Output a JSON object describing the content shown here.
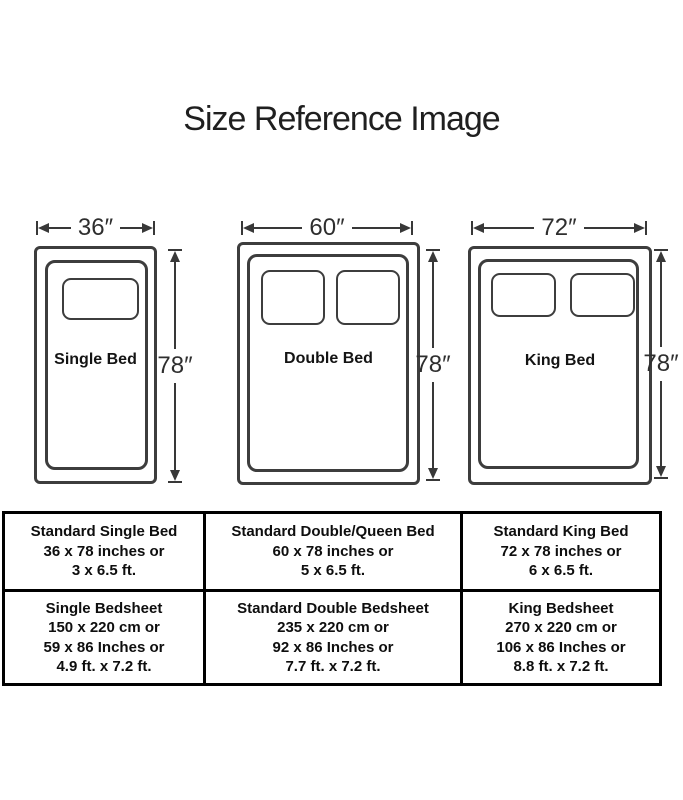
{
  "title": "Size Reference Image",
  "diagram": {
    "beds": [
      {
        "name": "Single Bed",
        "width_label": "36″",
        "height_label": "78″",
        "pillows": 1
      },
      {
        "name": "Double Bed",
        "width_label": "60″",
        "height_label": "78″",
        "pillows": 2
      },
      {
        "name": "King Bed",
        "width_label": "72″",
        "height_label": "78″",
        "pillows": 2
      }
    ]
  },
  "table": {
    "rows": [
      {
        "cells": [
          {
            "lines": [
              "Standard Single Bed",
              "36 x 78 inches or",
              "3 x 6.5 ft."
            ]
          },
          {
            "lines": [
              "Standard Double/Queen Bed",
              "60 x 78 inches or",
              "5 x 6.5 ft."
            ]
          },
          {
            "lines": [
              "Standard King Bed",
              "72 x 78 inches or",
              "6 x 6.5 ft."
            ]
          }
        ]
      },
      {
        "cells": [
          {
            "lines": [
              "Single Bedsheet",
              "150 x 220 cm or",
              "59 x 86 Inches or",
              "4.9 ft. x 7.2 ft."
            ]
          },
          {
            "lines": [
              "Standard Double Bedsheet",
              "235 x 220 cm or",
              "92 x 86 Inches or",
              "7.7 ft. x 7.2 ft."
            ]
          },
          {
            "lines": [
              "King Bedsheet",
              "270 x 220 cm or",
              "106 x 86 Inches or",
              "8.8 ft. x 7.2 ft."
            ]
          }
        ]
      }
    ]
  },
  "colors": {
    "line": "#3d3d3d",
    "text": "#1c1c1c",
    "table_border": "#000000",
    "background": "#ffffff"
  }
}
